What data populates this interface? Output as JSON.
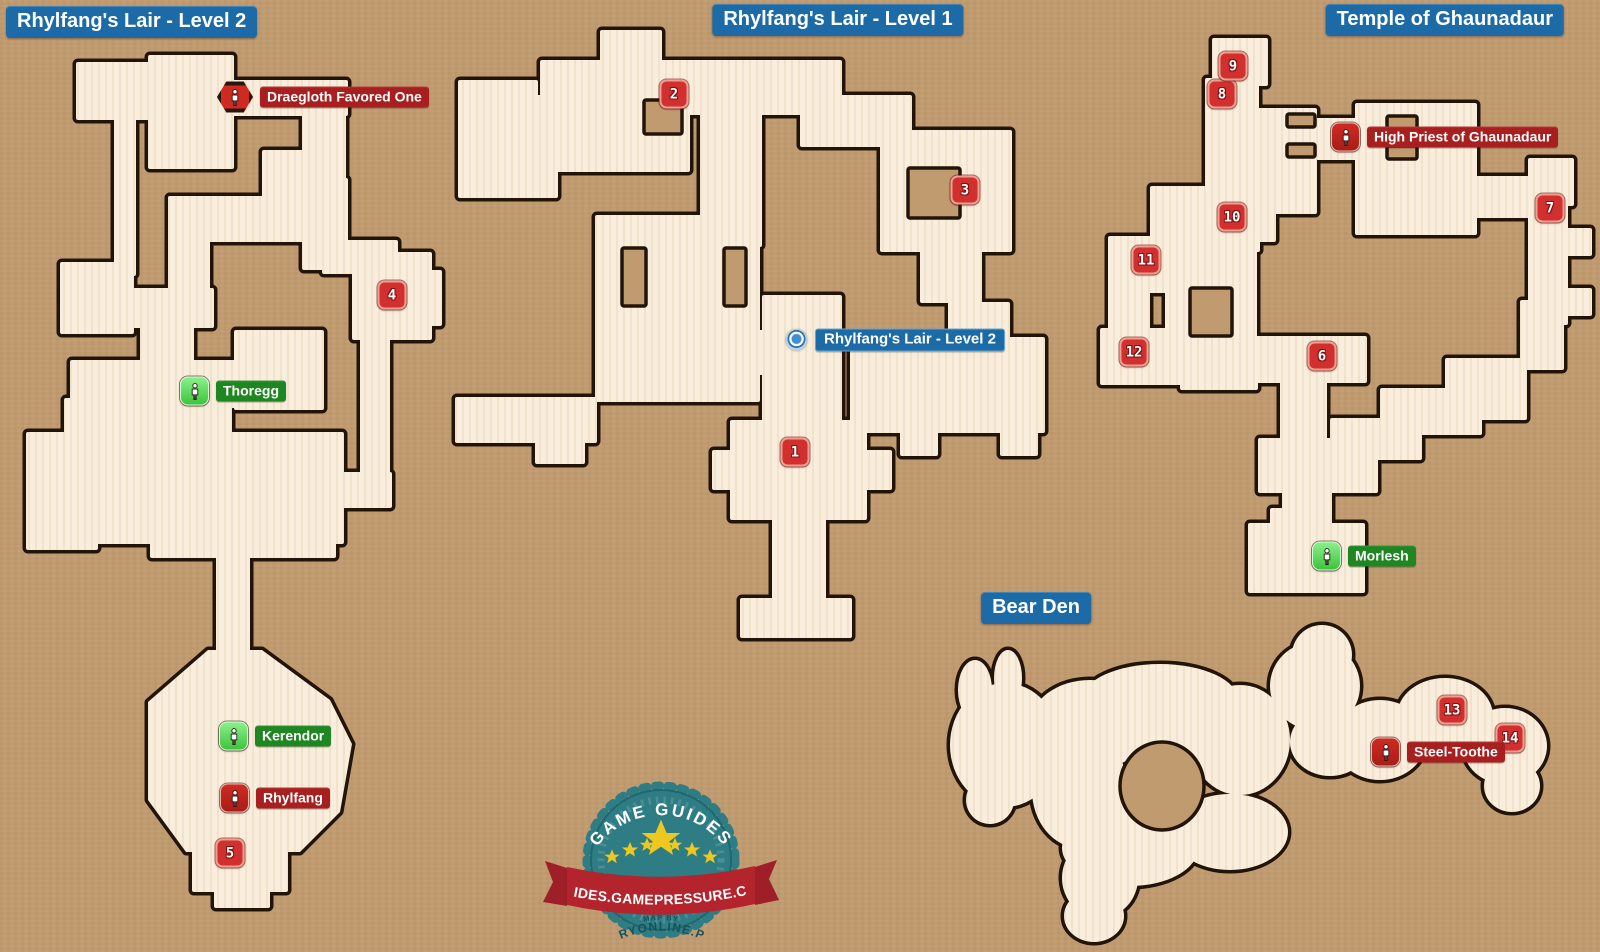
{
  "canvas": {
    "width": 1600,
    "height": 952
  },
  "colors": {
    "background": "#c19b70",
    "map_fill": "#f9eedd",
    "map_stripe": "#f0e2cb",
    "map_outline": "#221409",
    "title_bg": "#1d6ba6",
    "number_bg": "#d22f2f",
    "enemy_icon_bg": "#cf2a22",
    "enemy_label_bg": "#a81f1f",
    "friendly_icon_bg": "#3cc43c",
    "friendly_label_bg": "#1f8721",
    "exit_label_bg": "#1d6ba6",
    "logo_teal": "#2e7d85",
    "logo_ribbon": "#b3242d",
    "logo_star": "#eec81e"
  },
  "titles": [
    {
      "text": "Rhylfang's Lair - Level 2",
      "x": 6,
      "y": 6,
      "anchor": "left"
    },
    {
      "text": "Rhylfang's Lair - Level 1",
      "x": 838,
      "y": 4,
      "anchor": "center"
    },
    {
      "text": "Temple of Ghaunadaur",
      "x": 1564,
      "y": 4,
      "anchor": "right"
    },
    {
      "text": "Bear Den",
      "x": 1036,
      "y": 592,
      "anchor": "center"
    }
  ],
  "maps": [
    {
      "name": "rhylfangs-lair-level-2",
      "shapes": [
        [
          "r",
          76,
          62,
          92,
          58
        ],
        [
          "r",
          114,
          84,
          22,
          192
        ],
        [
          "r",
          60,
          262,
          74,
          72
        ],
        [
          "r",
          148,
          55,
          86,
          114
        ],
        [
          "r",
          196,
          80,
          152,
          36
        ],
        [
          "r",
          302,
          98,
          44,
          104
        ],
        [
          "r",
          262,
          150,
          62,
          60
        ],
        [
          "r",
          302,
          178,
          46,
          92
        ],
        [
          "r",
          322,
          240,
          76,
          34
        ],
        [
          "r",
          352,
          252,
          80,
          88
        ],
        [
          "r",
          420,
          270,
          22,
          56
        ],
        [
          "r",
          168,
          196,
          148,
          46
        ],
        [
          "r",
          168,
          196,
          42,
          122
        ],
        [
          "r",
          92,
          288,
          122,
          40
        ],
        [
          "r",
          140,
          300,
          54,
          112
        ],
        [
          "r",
          70,
          360,
          252,
          48
        ],
        [
          "r",
          234,
          330,
          90,
          80
        ],
        [
          "r",
          64,
          398,
          94,
          78
        ],
        [
          "r",
          26,
          432,
          72,
          118
        ],
        [
          "r",
          60,
          472,
          112,
          72
        ],
        [
          "r",
          150,
          402,
          82,
          140
        ],
        [
          "r",
          208,
          432,
          122,
          78
        ],
        [
          "r",
          282,
          432,
          62,
          112
        ],
        [
          "r",
          360,
          330,
          30,
          172
        ],
        [
          "r",
          300,
          472,
          92,
          36
        ],
        [
          "r",
          150,
          500,
          186,
          58
        ],
        [
          "r",
          216,
          556,
          34,
          114
        ],
        [
          "p",
          "148,702 208,650 262,650 330,700 352,744 340,812 300,852 186,852 148,800"
        ],
        [
          "r",
          192,
          842,
          96,
          50
        ],
        [
          "r",
          214,
          886,
          56,
          22
        ]
      ],
      "holes": []
    },
    {
      "name": "rhylfangs-lair-level-1",
      "shapes": [
        [
          "r",
          600,
          30,
          62,
          40
        ],
        [
          "r",
          540,
          60,
          150,
          112
        ],
        [
          "r",
          458,
          80,
          80,
          92
        ],
        [
          "r",
          518,
          95,
          72,
          45
        ],
        [
          "r",
          458,
          140,
          100,
          58
        ],
        [
          "r",
          650,
          60,
          192,
          55
        ],
        [
          "r",
          800,
          95,
          112,
          52
        ],
        [
          "r",
          700,
          110,
          62,
          137
        ],
        [
          "r",
          880,
          130,
          132,
          122
        ],
        [
          "r",
          920,
          245,
          62,
          58
        ],
        [
          "r",
          850,
          337,
          195,
          96
        ],
        [
          "r",
          948,
          302,
          62,
          40
        ],
        [
          "r",
          595,
          215,
          165,
          187
        ],
        [
          "r",
          700,
          330,
          80,
          45
        ],
        [
          "r",
          762,
          295,
          80,
          135
        ],
        [
          "r",
          455,
          397,
          142,
          46
        ],
        [
          "r",
          535,
          430,
          50,
          34
        ],
        [
          "r",
          730,
          420,
          137,
          100
        ],
        [
          "r",
          712,
          450,
          26,
          40
        ],
        [
          "r",
          862,
          450,
          30,
          40
        ],
        [
          "r",
          772,
          515,
          54,
          98
        ],
        [
          "r",
          740,
          598,
          112,
          40
        ],
        [
          "r",
          900,
          428,
          38,
          28
        ],
        [
          "r",
          1000,
          428,
          38,
          28
        ]
      ],
      "holes": [
        [
          "r",
          644,
          100,
          38,
          34
        ],
        [
          "r",
          622,
          248,
          24,
          58
        ],
        [
          "r",
          724,
          248,
          22,
          58
        ],
        [
          "r",
          908,
          168,
          52,
          50
        ]
      ]
    },
    {
      "name": "temple-of-ghaunadaur",
      "shapes": [
        [
          "r",
          1212,
          38,
          56,
          48
        ],
        [
          "r",
          1205,
          78,
          54,
          48
        ],
        [
          "r",
          1205,
          108,
          112,
          106
        ],
        [
          "r",
          1316,
          118,
          42,
          42
        ],
        [
          "r",
          1355,
          103,
          122,
          132
        ],
        [
          "r",
          1528,
          158,
          46,
          48
        ],
        [
          "r",
          1460,
          176,
          84,
          42
        ],
        [
          "r",
          1528,
          203,
          40,
          122
        ],
        [
          "r",
          1560,
          228,
          32,
          28
        ],
        [
          "r",
          1560,
          288,
          32,
          28
        ],
        [
          "r",
          1520,
          300,
          44,
          70
        ],
        [
          "r",
          1445,
          358,
          82,
          62
        ],
        [
          "r",
          1150,
          186,
          126,
          56
        ],
        [
          "r",
          1218,
          198,
          42,
          54
        ],
        [
          "r",
          1108,
          236,
          82,
          57
        ],
        [
          "r",
          1108,
          283,
          42,
          80
        ],
        [
          "r",
          1100,
          328,
          92,
          57
        ],
        [
          "r",
          1180,
          348,
          78,
          42
        ],
        [
          "r",
          1165,
          242,
          92,
          121
        ],
        [
          "r",
          1235,
          336,
          132,
          47
        ],
        [
          "r",
          1280,
          380,
          47,
          82
        ],
        [
          "r",
          1380,
          388,
          102,
          47
        ],
        [
          "r",
          1330,
          418,
          92,
          42
        ],
        [
          "r",
          1258,
          438,
          120,
          55
        ],
        [
          "r",
          1282,
          450,
          50,
          82
        ],
        [
          "r",
          1270,
          508,
          62,
          28
        ],
        [
          "r",
          1248,
          523,
          117,
          70
        ]
      ],
      "holes": [
        [
          "r",
          1287,
          114,
          28,
          13
        ],
        [
          "r",
          1287,
          144,
          28,
          13
        ],
        [
          "r",
          1387,
          116,
          30,
          13
        ],
        [
          "r",
          1387,
          146,
          30,
          13
        ],
        [
          "r",
          1190,
          288,
          42,
          48
        ]
      ]
    },
    {
      "name": "bear-den",
      "shapes": [
        [
          "e",
          1005,
          745,
          55,
          62
        ],
        [
          "e",
          975,
          690,
          17,
          30
        ],
        [
          "e",
          1008,
          678,
          14,
          28
        ],
        [
          "e",
          990,
          800,
          24,
          24
        ],
        [
          "e",
          1060,
          742,
          46,
          30
        ],
        [
          "e",
          1042,
          722,
          30,
          22
        ],
        [
          "e",
          1090,
          725,
          60,
          45
        ],
        [
          "e",
          1160,
          700,
          78,
          36
        ],
        [
          "e",
          1170,
          730,
          60,
          26
        ],
        [
          "e",
          1240,
          740,
          50,
          55
        ],
        [
          "e",
          1230,
          832,
          58,
          38
        ],
        [
          "e",
          1130,
          848,
          68,
          38
        ],
        [
          "e",
          1080,
          790,
          48,
          58
        ],
        [
          "e",
          1315,
          686,
          45,
          44
        ],
        [
          "e",
          1322,
          655,
          30,
          30
        ],
        [
          "e",
          1330,
          742,
          40,
          34
        ],
        [
          "e",
          1380,
          740,
          46,
          40
        ],
        [
          "e",
          1445,
          716,
          48,
          38
        ],
        [
          "e",
          1505,
          746,
          42,
          38
        ],
        [
          "e",
          1512,
          786,
          28,
          26
        ],
        [
          "e",
          1100,
          878,
          38,
          40
        ],
        [
          "e",
          1094,
          916,
          30,
          26
        ]
      ],
      "holes": [
        [
          "e",
          1162,
          786,
          42,
          44
        ]
      ]
    }
  ],
  "markers": {
    "numbers": [
      {
        "n": "1",
        "x": 795,
        "y": 452
      },
      {
        "n": "2",
        "x": 674,
        "y": 94
      },
      {
        "n": "3",
        "x": 965,
        "y": 190
      },
      {
        "n": "4",
        "x": 392,
        "y": 295
      },
      {
        "n": "5",
        "x": 230,
        "y": 853
      },
      {
        "n": "6",
        "x": 1322,
        "y": 356
      },
      {
        "n": "7",
        "x": 1550,
        "y": 208
      },
      {
        "n": "8",
        "x": 1222,
        "y": 94
      },
      {
        "n": "9",
        "x": 1233,
        "y": 66
      },
      {
        "n": "10",
        "x": 1232,
        "y": 217
      },
      {
        "n": "11",
        "x": 1146,
        "y": 260
      },
      {
        "n": "12",
        "x": 1134,
        "y": 352
      },
      {
        "n": "13",
        "x": 1452,
        "y": 710
      },
      {
        "n": "14",
        "x": 1510,
        "y": 738
      }
    ],
    "npcs": [
      {
        "name": "Draegloth Favored One",
        "kind": "enemy",
        "boss": true,
        "x": 235,
        "y": 97
      },
      {
        "name": "Thoregg",
        "kind": "friendly",
        "boss": false,
        "x": 194,
        "y": 391
      },
      {
        "name": "Kerendor",
        "kind": "friendly",
        "boss": false,
        "x": 233,
        "y": 736
      },
      {
        "name": "Rhylfang",
        "kind": "enemy",
        "boss": false,
        "x": 234,
        "y": 798
      },
      {
        "name": "High Priest of Ghaunadaur",
        "kind": "enemy",
        "boss": false,
        "x": 1345,
        "y": 137
      },
      {
        "name": "Morlesh",
        "kind": "friendly",
        "boss": false,
        "x": 1326,
        "y": 556
      },
      {
        "name": "Steel-Toothe",
        "kind": "enemy",
        "boss": false,
        "x": 1385,
        "y": 752
      }
    ],
    "exits": [
      {
        "label": "Rhylfang's Lair - Level 2",
        "x": 797,
        "y": 340
      }
    ]
  },
  "logo": {
    "arc_text": "GAME GUIDES",
    "ribbon_text": "GUIDES.GAMEPRESSURE.COM",
    "map_by": "MAP BY",
    "map_by_site": "GRYONLINE.PL"
  }
}
